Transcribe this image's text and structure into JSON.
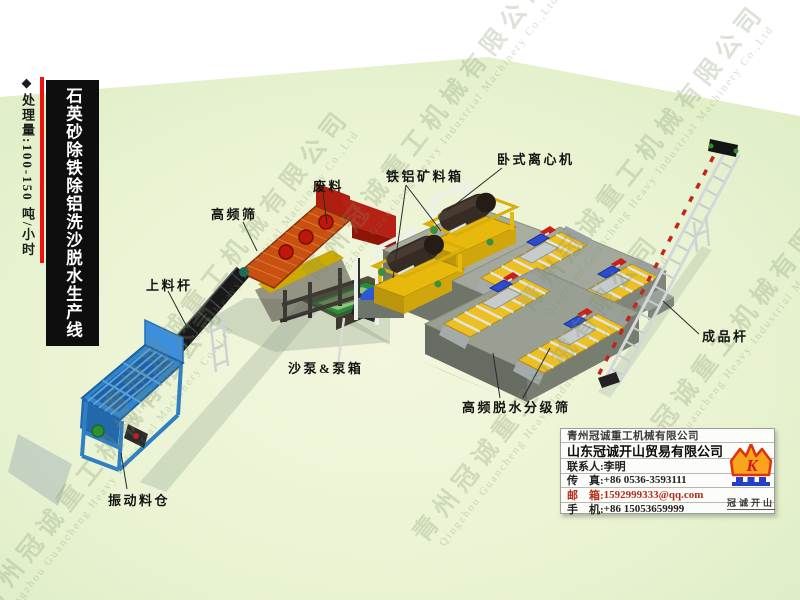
{
  "banner": {
    "capacity": "◆处理量:100-150 吨/小时",
    "title": "石英砂除铁除铝洗沙脱水生产线"
  },
  "labels": {
    "feed_conveyor": "上料杆",
    "hf_screen": "高频筛",
    "waste": "废料",
    "ore_box": "铁铝矿料箱",
    "centrifuge": "卧式离心机",
    "sand_pump": "沙泵&泵箱",
    "vib_hopper": "振动料仓",
    "dewater_screen": "高频脱水分级筛",
    "product_conveyor": "成品杆"
  },
  "watermark": {
    "cn": "青州冠诚重工机械有限公司",
    "en": "Qingzhou Guancheng Heavy Industrial Machinery Co.,Ltd"
  },
  "contact": {
    "company1": "青州冠诚重工机械有限公司",
    "company2": "山东冠诚开山贸易有限公司",
    "person_label": "联系人:",
    "person": "李明",
    "fax_label": "传　真:",
    "fax": "+86 0536-3593111",
    "email_label": "邮　箱:",
    "email": "1592999333@qq.com",
    "mobile_label": "手　机:",
    "mobile": "+86 15053659999",
    "logo_letter": "K",
    "logo_text": "冠诚开山"
  },
  "colors": {
    "ground_green": "#e6f2cd",
    "banner_black": "#0e0e0e",
    "accent_red": "#ee1111",
    "hopper_blue": "#2f86cf",
    "screen_orange": "#c85010",
    "frame_red": "#b01e10",
    "machine_yellow": "#e7b90c",
    "deck_yellow": "#ecbf25",
    "motor_blue": "#2b4ccf",
    "motor_red": "#c82118",
    "tank_green": "#2e8b3c",
    "email_red": "#b32d18",
    "crown_orange": "#f8a41c",
    "crown_red": "#e03010",
    "logo_base_blue": "#2440c4"
  }
}
